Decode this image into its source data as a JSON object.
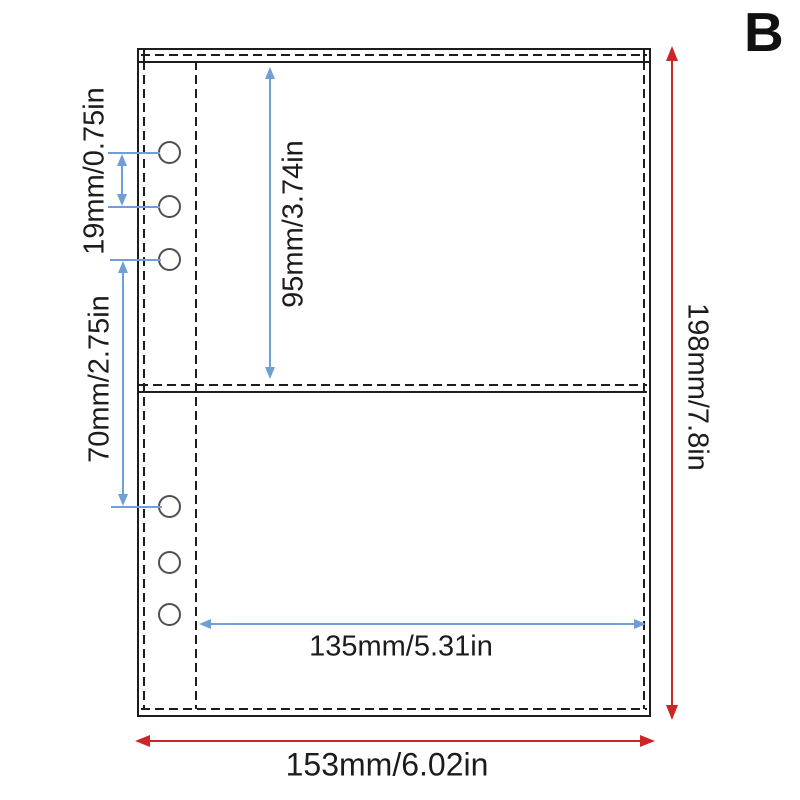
{
  "figure_label": "B",
  "colors": {
    "outline": "#1d1d1d",
    "dimension_blue": "#6f9fd6",
    "dimension_red": "#cd2626",
    "hole_outline": "#4f4f4f",
    "background": "#ffffff"
  },
  "dimensions": {
    "hole_spacing": "19mm/0.75in",
    "hole_group_gap": "70mm/2.75in",
    "top_pocket_height": "95mm/3.74in",
    "pocket_width": "135mm/5.31in",
    "page_height": "198mm/7.8in",
    "page_width": "153mm/6.02in"
  }
}
